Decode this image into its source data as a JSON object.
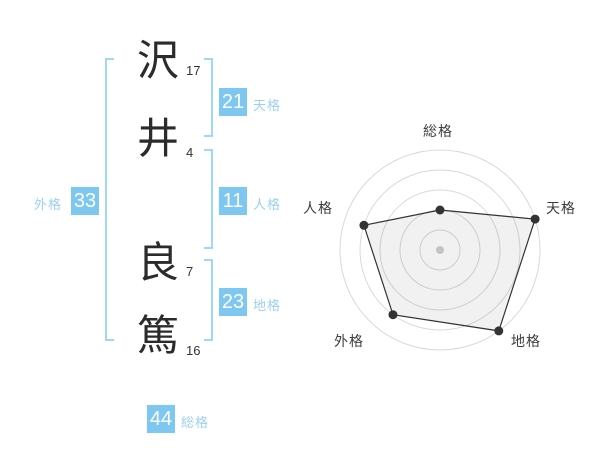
{
  "figure": {
    "characters": [
      {
        "char": "沢",
        "strokes": "17"
      },
      {
        "char": "井",
        "strokes": "4"
      },
      {
        "char": "良",
        "strokes": "7"
      },
      {
        "char": "篤",
        "strokes": "16"
      }
    ],
    "grids": {
      "tenkaku": {
        "value": "21",
        "label": "天格"
      },
      "jinkaku": {
        "value": "11",
        "label": "人格"
      },
      "chikaku": {
        "value": "23",
        "label": "地格"
      },
      "gaikaku": {
        "value": "33",
        "label": "外格"
      },
      "soukaku": {
        "value": "44",
        "label": "総格"
      }
    },
    "colors": {
      "value_box": "#7dc7f0",
      "bracket": "#a0d8f7",
      "grid_label_text": "#9bd0f2",
      "value_text": "#ffffff",
      "stroke_number_text": "#333333"
    }
  },
  "chart_data": {
    "type": "radar",
    "axes": [
      "総格",
      "天格",
      "地格",
      "外格",
      "人格"
    ],
    "values": [
      2,
      5,
      5,
      4,
      4
    ],
    "max": 5,
    "rings": 5,
    "grid_shape": "circles",
    "legend": "none",
    "ring_color": "#d9d9d9",
    "center_dot_color": "#c4c4c4",
    "series_color": "#333333",
    "fill_color": "rgba(0,0,0,0.055)"
  }
}
